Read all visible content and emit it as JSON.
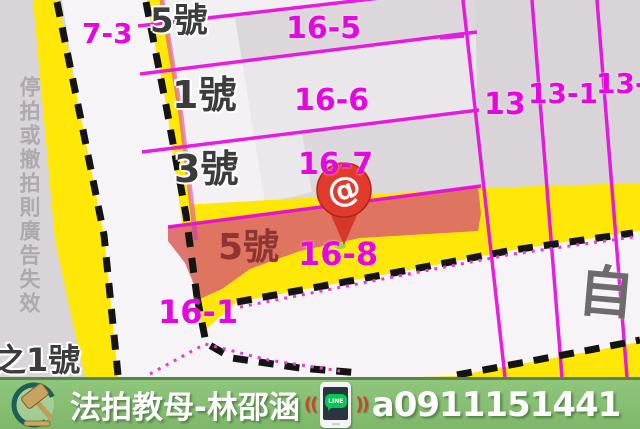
{
  "map": {
    "watermark_vertical": "停拍或撤拍則廣告失效",
    "labels": {
      "parcel_7_3": "7-3",
      "house_5_top": "5號",
      "parcel_16_5": "16-5",
      "house_1": "1號",
      "parcel_16_6": "16-6",
      "house_3": "3號",
      "parcel_16_7": "16-7",
      "house_5_highlight": "5號",
      "parcel_16_8": "16-8",
      "parcel_16_1": "16-1",
      "parcel_13": "13",
      "parcel_13_1": "13-1",
      "parcel_13_1_clipped": "13-1",
      "house_of_1": "之1號",
      "road_name": "自"
    },
    "marker": {
      "type": "location-pin",
      "glyph": "@",
      "color": "#e23b2e"
    },
    "colors": {
      "parcel_line_magenta": "#e607e0",
      "road_yellow": "#ffe808",
      "highlight_red": "#dd6a67",
      "background_gray": "#d8d4d8",
      "road_white": "#f6f4f6"
    }
  },
  "banner": {
    "brand": "法拍教母-林邵涵",
    "phone": "a0911151441",
    "line_label": "LINE",
    "sound_left": "((",
    "sound_right": "))",
    "background": "#87bd74"
  }
}
